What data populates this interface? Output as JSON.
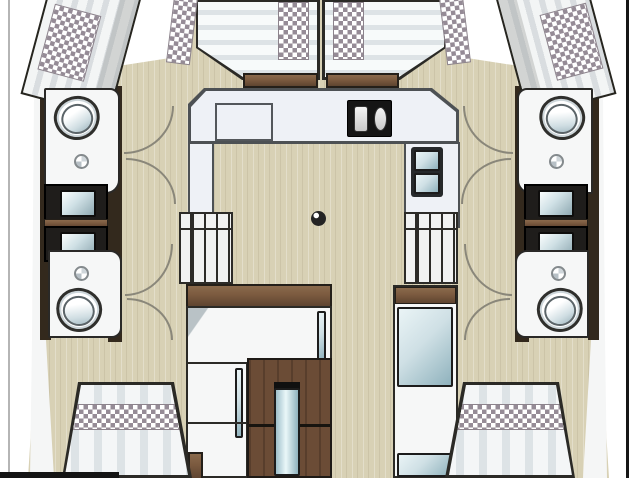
{
  "document": {
    "type": "catamaran interior floor plan, top-down view",
    "contains_text": false
  },
  "palette": {
    "pageBg": "#ffffff",
    "frameLight": "#b5b5b5",
    "frameDark": "#161616",
    "floor": "#d8d1b5",
    "hullWhite": "#f6f7f7",
    "outline": "#2b2a26",
    "trimDark": "#33291d",
    "wood": "#7b5a3f",
    "woodDark": "#6b4c36",
    "counter": "#eef1f6",
    "counterEdge": "#4d5154",
    "fixtureDark": "#1f1d1b",
    "glassHi": "#eaf4f6",
    "glassLo": "#8fb2bd",
    "checker": "#958b96",
    "cushionHi": "#f7fafa",
    "cushionLo": "#dde3e6",
    "berthStripe": "#d9dde0",
    "arcLine": "#8a877a",
    "toiletRim": "#2f2f2c"
  },
  "vessel": {
    "layout": "catamaran: two hulls joined by central bridgedeck saloon",
    "bridgedeck": {
      "forward_cockpit": {
        "seat_cushions": 2,
        "checker_pillow_patches": 2,
        "side_bolster_cushions": 2,
        "wood_tables": 2
      },
      "galley": {
        "shape": "U",
        "stove_burners": 2,
        "sink_basins": 2,
        "counter_hatch_outlines": 1
      },
      "saloon": {
        "floor_table_fitting": 1,
        "hull_staircases": 2,
        "visible_steps_per_staircase": 4
      },
      "aft": {
        "wood_entry_door": 1,
        "door_glass_slit": 1,
        "window_glass_units": 2,
        "side_cabinet": 1
      }
    },
    "left_hull": {
      "bow_berth": 1,
      "forward_head": {
        "toilet": 1,
        "shower_drain": 1
      },
      "vanity_sink_units": 2,
      "aft_head": {
        "toilet": 1,
        "shower_drain": 1
      },
      "aft_berth": 1,
      "door_swing_arcs": 4
    },
    "right_hull": {
      "bow_berth": 1,
      "forward_head": {
        "toilet": 1,
        "shower_drain": 1
      },
      "vanity_sink_units": 2,
      "aft_head": {
        "toilet": 1,
        "shower_drain": 1
      },
      "aft_berth": 1,
      "door_swing_arcs": 4
    }
  }
}
